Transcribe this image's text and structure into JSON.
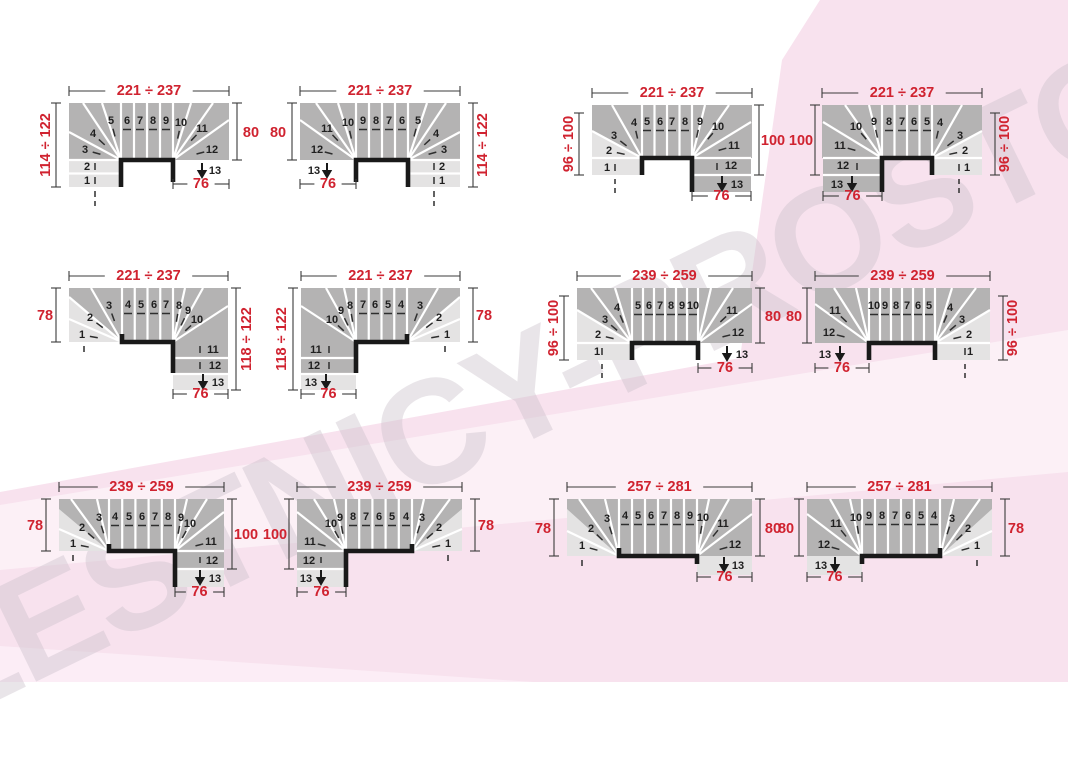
{
  "watermark": {
    "text": "LESTNICY-PROSTO.RU"
  },
  "icons": {
    "exit_arrow": "triangle-down-icon"
  },
  "colors": {
    "accent_red": "#d02330",
    "tread_dark": "#b4b3b3",
    "tread_light": "#e4e3e3",
    "line_white": "#ffffff",
    "line_black": "#191919",
    "dim_line": "#3b3b3b",
    "step_number": "#1f1f1f",
    "background_pink": "#f8e2ee",
    "background_light_pink": "#fdf3f9"
  },
  "diagrams": [
    {
      "dims": {
        "top": "221 ÷ 237",
        "left": "114 ÷ 122",
        "right": "80",
        "bottom": "76"
      },
      "steps": [
        "1",
        "2",
        "3",
        "4",
        "5",
        "6",
        "7",
        "8",
        "9",
        "10",
        "11",
        "12",
        "13"
      ]
    },
    {
      "dims": {
        "top": "221 ÷ 237",
        "left": "80",
        "right": "114 ÷ 122",
        "bottom": "76"
      },
      "steps": [
        "1",
        "2",
        "3",
        "4",
        "5",
        "6",
        "7",
        "8",
        "9",
        "10",
        "11",
        "12",
        "13"
      ]
    },
    {
      "dims": {
        "top": "221 ÷ 237",
        "left": "96 ÷ 100",
        "right": "100",
        "bottom": "76"
      },
      "steps": [
        "1",
        "2",
        "3",
        "4",
        "5",
        "6",
        "7",
        "8",
        "9",
        "10",
        "11",
        "12",
        "13"
      ]
    },
    {
      "dims": {
        "top": "221 ÷ 237",
        "left": "100",
        "right": "96 ÷ 100",
        "bottom": "76"
      },
      "steps": [
        "1",
        "2",
        "3",
        "4",
        "5",
        "6",
        "7",
        "8",
        "9",
        "10",
        "11",
        "12",
        "13"
      ]
    },
    {
      "dims": {
        "top": "221 ÷ 237",
        "left": "78",
        "right": "118 ÷ 122",
        "bottom": "76"
      },
      "steps": [
        "1",
        "2",
        "3",
        "4",
        "5",
        "6",
        "7",
        "8",
        "9",
        "10",
        "11",
        "12",
        "13"
      ]
    },
    {
      "dims": {
        "top": "221 ÷ 237",
        "left": "118 ÷ 122",
        "right": "78",
        "bottom": "76"
      },
      "steps": [
        "1",
        "2",
        "3",
        "4",
        "5",
        "6",
        "7",
        "8",
        "9",
        "10",
        "11",
        "12",
        "13"
      ]
    },
    {
      "dims": {
        "top": "239 ÷ 259",
        "left": "96 ÷ 100",
        "right": "80",
        "bottom": "76"
      },
      "steps": [
        "1",
        "2",
        "3",
        "4",
        "5",
        "6",
        "7",
        "8",
        "9",
        "10",
        "11",
        "12",
        "13"
      ]
    },
    {
      "dims": {
        "top": "239 ÷ 259",
        "left": "80",
        "right": "96 ÷ 100",
        "bottom": "76"
      },
      "steps": [
        "1",
        "2",
        "3",
        "4",
        "5",
        "6",
        "7",
        "8",
        "9",
        "10",
        "11",
        "12",
        "13"
      ]
    },
    {
      "dims": {
        "top": "239 ÷ 259",
        "left": "78",
        "right": "100",
        "bottom": "76"
      },
      "steps": [
        "1",
        "2",
        "3",
        "4",
        "5",
        "6",
        "7",
        "8",
        "9",
        "10",
        "11",
        "12",
        "13"
      ]
    },
    {
      "dims": {
        "top": "239 ÷ 259",
        "left": "100",
        "right": "78",
        "bottom": "76"
      },
      "steps": [
        "1",
        "2",
        "3",
        "4",
        "5",
        "6",
        "7",
        "8",
        "9",
        "10",
        "11",
        "12",
        "13"
      ]
    },
    {
      "dims": {
        "top": "257 ÷ 281",
        "left": "78",
        "right": "80",
        "bottom": "76"
      },
      "steps": [
        "1",
        "2",
        "3",
        "4",
        "5",
        "6",
        "7",
        "8",
        "9",
        "10",
        "11",
        "12",
        "13"
      ]
    },
    {
      "dims": {
        "top": "257 ÷ 281",
        "left": "80",
        "right": "78",
        "bottom": "76"
      },
      "steps": [
        "1",
        "2",
        "3",
        "4",
        "5",
        "6",
        "7",
        "8",
        "9",
        "10",
        "11",
        "12",
        "13"
      ]
    }
  ]
}
